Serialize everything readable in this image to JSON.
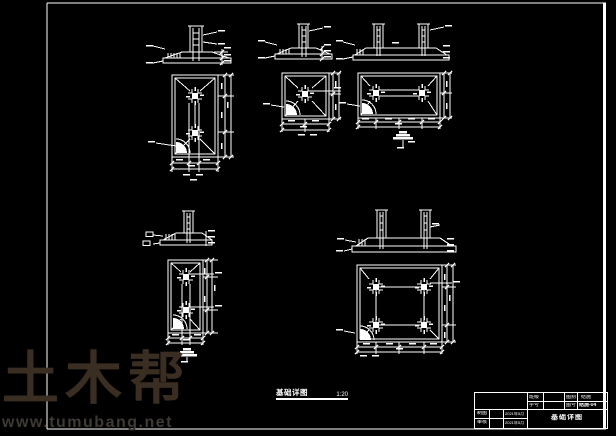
{
  "canvas": {
    "background": "#000000",
    "line_color": "#ffffff"
  },
  "watermark": {
    "brand": "土木帮",
    "url": "www.tumubang.net",
    "brand_color": "#3a2d22",
    "url_color": "#3e3a35"
  },
  "drawing_label": {
    "title": "基础详图",
    "scale": "1:20"
  },
  "title_block": {
    "class_label": "班级",
    "class_value": "",
    "student_label": "学号",
    "student_value": "",
    "category_label": "图别",
    "category_value": "结施",
    "number_label": "图号",
    "number_value": "结施-04",
    "draft_label": "制图",
    "draft_value": "",
    "draft_date": "2021年5月",
    "review_label": "审核",
    "review_value": "",
    "review_date": "2021年5月",
    "drawing_title": "基础详图"
  }
}
